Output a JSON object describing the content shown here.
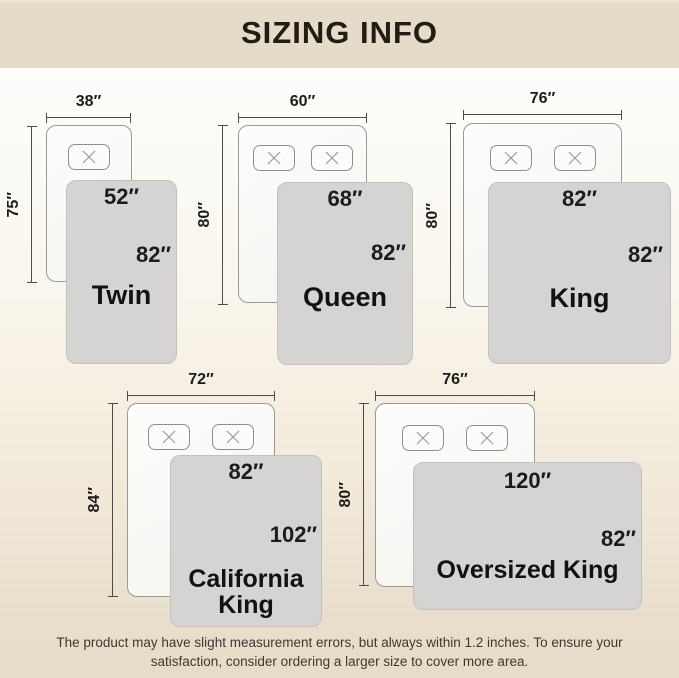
{
  "header": {
    "title": "SIZING INFO"
  },
  "sizes": [
    {
      "name": "Twin",
      "bed_width": "38″",
      "bed_length": "75″",
      "cover_width": "52″",
      "cover_length": "82″"
    },
    {
      "name": "Queen",
      "bed_width": "60″",
      "bed_length": "80″",
      "cover_width": "68″",
      "cover_length": "82″"
    },
    {
      "name": "King",
      "bed_width": "76″",
      "bed_length": "80″",
      "cover_width": "82″",
      "cover_length": "82″"
    },
    {
      "name": "California King",
      "bed_width": "72″",
      "bed_length": "84″",
      "cover_width": "82″",
      "cover_length": "102″"
    },
    {
      "name": "Oversized King",
      "bed_width": "76″",
      "bed_length": "80″",
      "cover_width": "120″",
      "cover_length": "82″"
    }
  ],
  "footer": {
    "note_line1": "The product may have slight measurement errors, but always within 1.2 inches. To ensure your",
    "note_line2": "satisfaction, consider ordering a larger size to cover more area."
  },
  "icons": {
    "pillow_marker": "x-cross"
  },
  "colors": {
    "band": "#e4dbc9",
    "cover_gray": "#d5d4d2",
    "bed_white": "#fcfcfa",
    "text_dark": "#1c1c1a"
  }
}
